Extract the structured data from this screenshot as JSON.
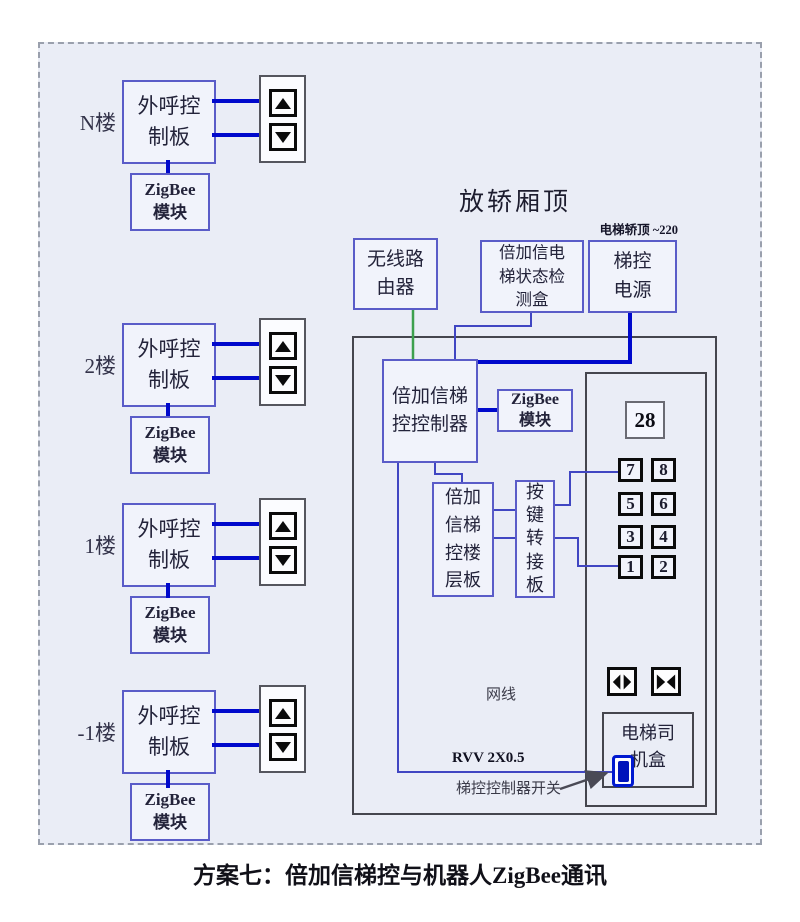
{
  "diagram": {
    "left_units": [
      {
        "floor": "N楼",
        "board": "外呼控\n制板",
        "module": "ZigBee\n模块"
      },
      {
        "floor": "2楼",
        "board": "外呼控\n制板",
        "module": "ZigBee\n模块"
      },
      {
        "floor": "1楼",
        "board": "外呼控\n制板",
        "module": "ZigBee\n模块"
      },
      {
        "floor": "-1楼",
        "board": "外呼控\n制板",
        "module": "ZigBee\n模块"
      }
    ],
    "cartop": {
      "title": "放轿厢顶",
      "power_note": "电梯轿顶 ~220",
      "router": "无线路\n由器",
      "detector": "倍加信电\n梯状态检\n测盒",
      "power_supply": "梯控\n电源",
      "controller": "倍加信梯\n控控制器",
      "zigbee_module": "ZigBee\n模块",
      "floor_board": "倍加\n信梯\n控楼\n层板",
      "key_adapter": "按\n键\n转\n接\n板",
      "display_value": "28",
      "panel_buttons": [
        "7",
        "8",
        "5",
        "6",
        "3",
        "4",
        "1",
        "2"
      ],
      "network_label": "网线",
      "cable_label": "RVV 2X0.5",
      "switch_label": "梯控控制器开关",
      "driver_box": "电梯司\n机盒"
    },
    "caption": "方案七：倍加信梯控与机器人ZigBee通讯",
    "colors": {
      "line_blue": "#0009cc",
      "line_thin_blue": "#4046c2",
      "line_green": "#3da04e",
      "box_border_blue": "#5a5cc8",
      "switch_blue": "#0013bb"
    }
  }
}
